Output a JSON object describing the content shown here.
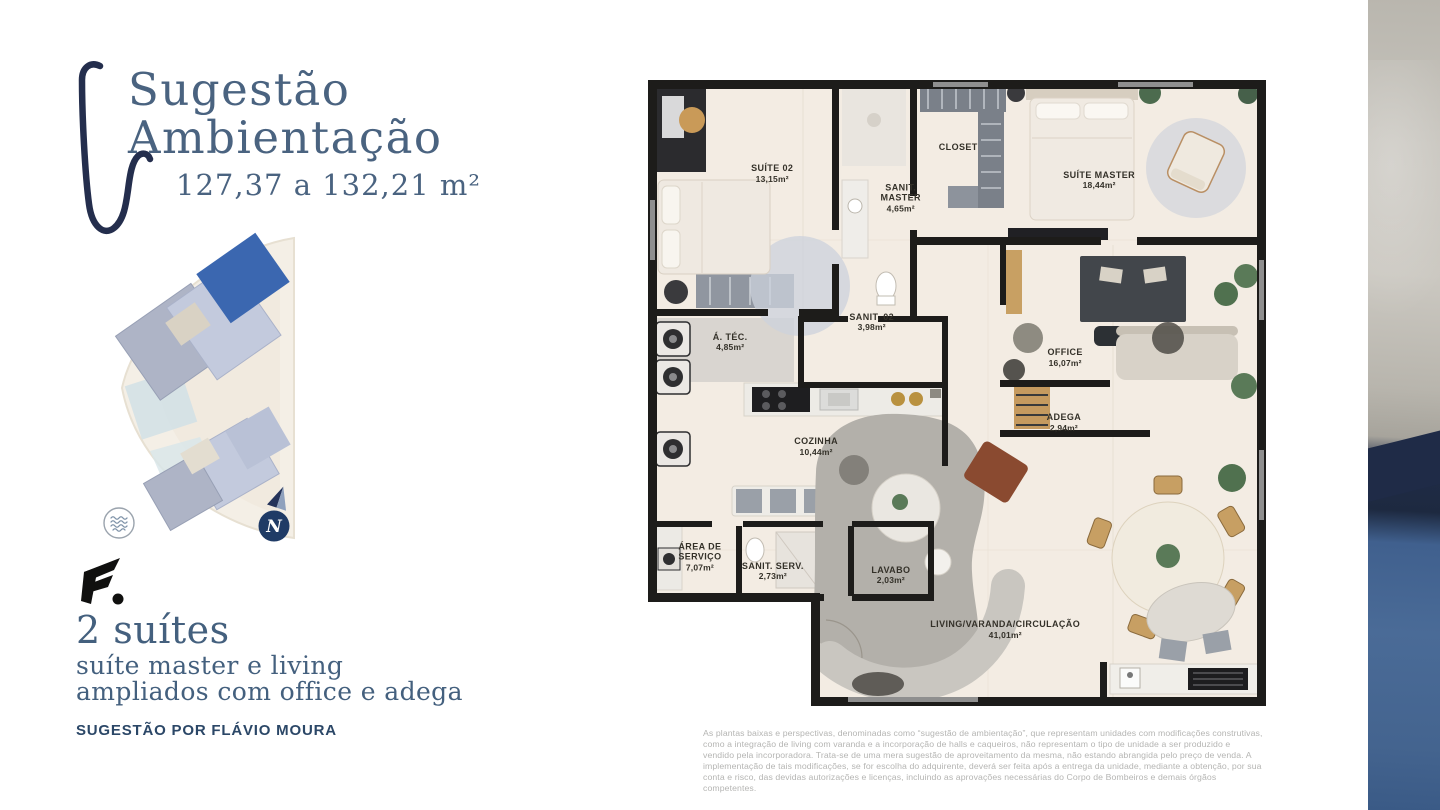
{
  "header": {
    "title_line1": "Sugestão",
    "title_line2": "Ambientação",
    "area_range": "127,37 a 132,21 m²"
  },
  "left_panel": {
    "logo_text": "F.",
    "icons": [
      "waves-icon",
      "compass-north-icon",
      "developer-logo",
      "decorative-swoosh"
    ],
    "compass_letter": "N",
    "headline": "2 suítes",
    "subline1": "suíte master e living",
    "subline2": "ampliados com office e adega",
    "credit": "SUGESTÃO POR FLÁVIO MOURA"
  },
  "floor_plan": {
    "rooms": [
      {
        "name": "SUÍTE 02",
        "area": "13,15m²",
        "x": 20.1,
        "y": 14.7
      },
      {
        "name": "SANIT.\nMASTER",
        "area": "4,65m²",
        "x": 40.9,
        "y": 18.6
      },
      {
        "name": "CLOSET",
        "area": "",
        "x": 50.2,
        "y": 10.6
      },
      {
        "name": "SUÍTE MASTER",
        "area": "18,44m²",
        "x": 73.0,
        "y": 15.7
      },
      {
        "name": "Á. TÉC.",
        "area": "4,85m²",
        "x": 13.3,
        "y": 41.3
      },
      {
        "name": "SANIT. 02",
        "area": "3,98m²",
        "x": 36.2,
        "y": 38.1
      },
      {
        "name": "OFFICE",
        "area": "16,07m²",
        "x": 67.5,
        "y": 43.7
      },
      {
        "name": "ADEGA",
        "area": "2,94m²",
        "x": 67.3,
        "y": 54.0
      },
      {
        "name": "COZINHA",
        "area": "10,44m²",
        "x": 27.2,
        "y": 57.8
      },
      {
        "name": "ÁREA DE\nSERVIÇO",
        "area": "7,07m²",
        "x": 8.4,
        "y": 75.2
      },
      {
        "name": "SANIT. SERV.",
        "area": "2,73m²",
        "x": 20.2,
        "y": 77.4
      },
      {
        "name": "LAVABO",
        "area": "2,03m²",
        "x": 39.3,
        "y": 78.0
      },
      {
        "name": "LIVING/VARANDA/CIRCULAÇÃO",
        "area": "41,01m²",
        "x": 57.8,
        "y": 86.6
      }
    ]
  },
  "disclaimer": "As plantas baixas e perspectivas, denominadas como “sugestão de ambientação”, que representam unidades com modificações construtivas, como a integração de living com varanda e a incorporação de halls e caqueiros, não representam o tipo de unidade a ser produzido e vendido pela incorporadora. Trata-se de uma mera sugestão de aproveitamento da mesma, não estando abrangida pelo preço de venda. A implementação de tais modificações, se for escolha do adquirente, deverá ser feita após a entrega da unidade, mediante a obtenção, por sua conta e risco, das devidas autorizações e licenças, incluindo as aprovações necessárias do Corpo de Bombeiros e demais órgãos competentes.",
  "colors": {
    "title_blue": "#4a6380",
    "credit_navy": "#2b4767",
    "accent_navy": "#242e4d",
    "highlight_building_blue": "#3b67b0",
    "wall_black": "#1d1c1a",
    "floor_cream": "#f3ece3",
    "disclaimer_gray": "#b5b5b3"
  }
}
